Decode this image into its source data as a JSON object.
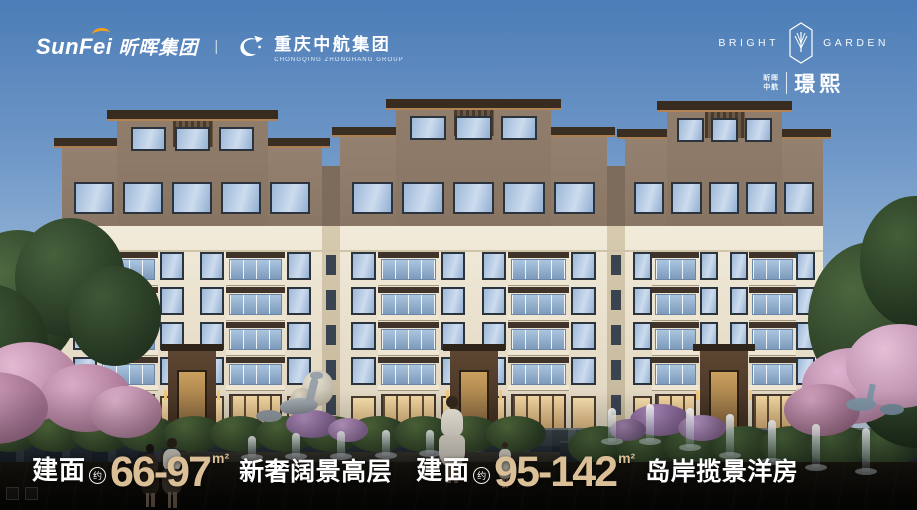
{
  "meta": {
    "canvas_width": 917,
    "canvas_height": 510
  },
  "header": {
    "sunfei_brand_en": "SunFei",
    "sunfei_brand_cn": "昕晖集团",
    "divider": "|",
    "zhonghang_name_cn": "重庆中航集团",
    "zhonghang_name_en": "CHONGQING ZHONGHANG GROUP"
  },
  "project_logo": {
    "word_left": "BRIGHT",
    "word_right": "GARDEN",
    "sub_line1": "昕晖",
    "sub_line2": "中航",
    "project_name": "璟熙"
  },
  "headline": {
    "segments": [
      {
        "label": "建面",
        "approx": "约",
        "range": "66-97",
        "unit": "m²",
        "desc": "新奢阔景高层"
      },
      {
        "label": "建面",
        "approx": "约",
        "range": "95-142",
        "unit": "m²",
        "desc": "岛岸揽景洋房"
      }
    ]
  },
  "palette": {
    "gold": "#dbbf96",
    "accent_orange": "#f3a11c",
    "sky_top": "#4c7db7",
    "sky_bottom": "#cfdfec",
    "cream_wall": "#ebe2cd",
    "penthouse_wall": "#8d7a69",
    "roof_dark": "#382b20",
    "water_dark": "#2a343d",
    "blossom_pink": "#dfb3cf"
  }
}
